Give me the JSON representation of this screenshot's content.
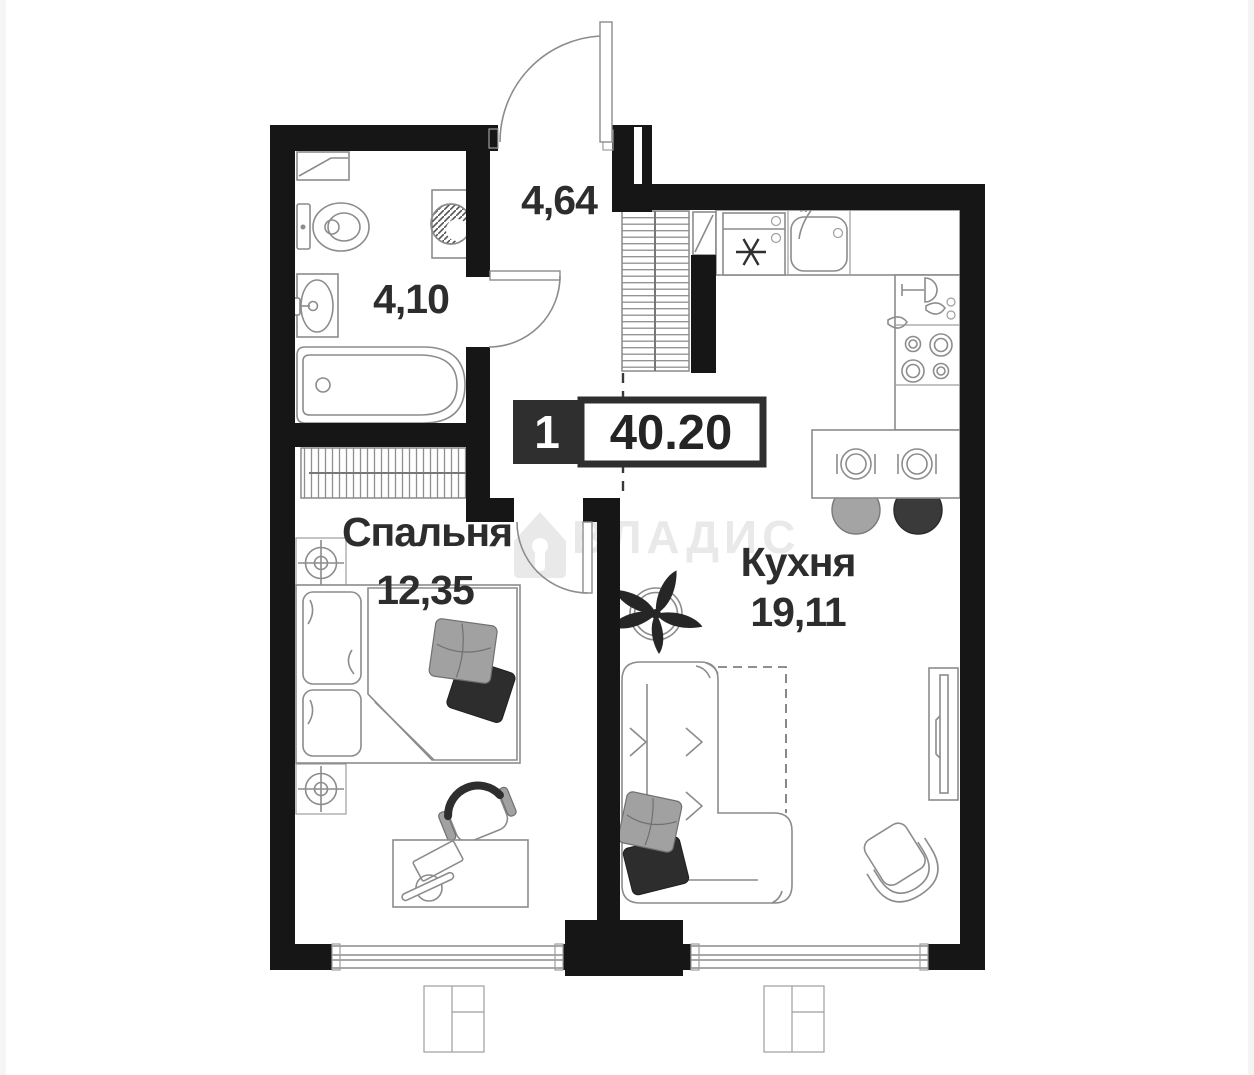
{
  "badge": {
    "rooms_count": "1",
    "total_area": "40.20"
  },
  "rooms": {
    "hallway": {
      "area": "4,64"
    },
    "bathroom": {
      "area": "4,10"
    },
    "bedroom": {
      "name": "Спальня",
      "area": "12,35"
    },
    "kitchen": {
      "name": "Кухня",
      "area": "19,11"
    }
  },
  "watermark": {
    "brand": "ВЛАДИС"
  },
  "colors": {
    "wall": "#161616",
    "furniture_line": "#8c8c8c",
    "label_text": "#2d2d2d",
    "badge_dark": "#2f2f2f",
    "soft_gray_fill": "#a1a1a1",
    "dark_fill": "#2d2d2d",
    "watermark_gray": "#e9e9e9"
  }
}
